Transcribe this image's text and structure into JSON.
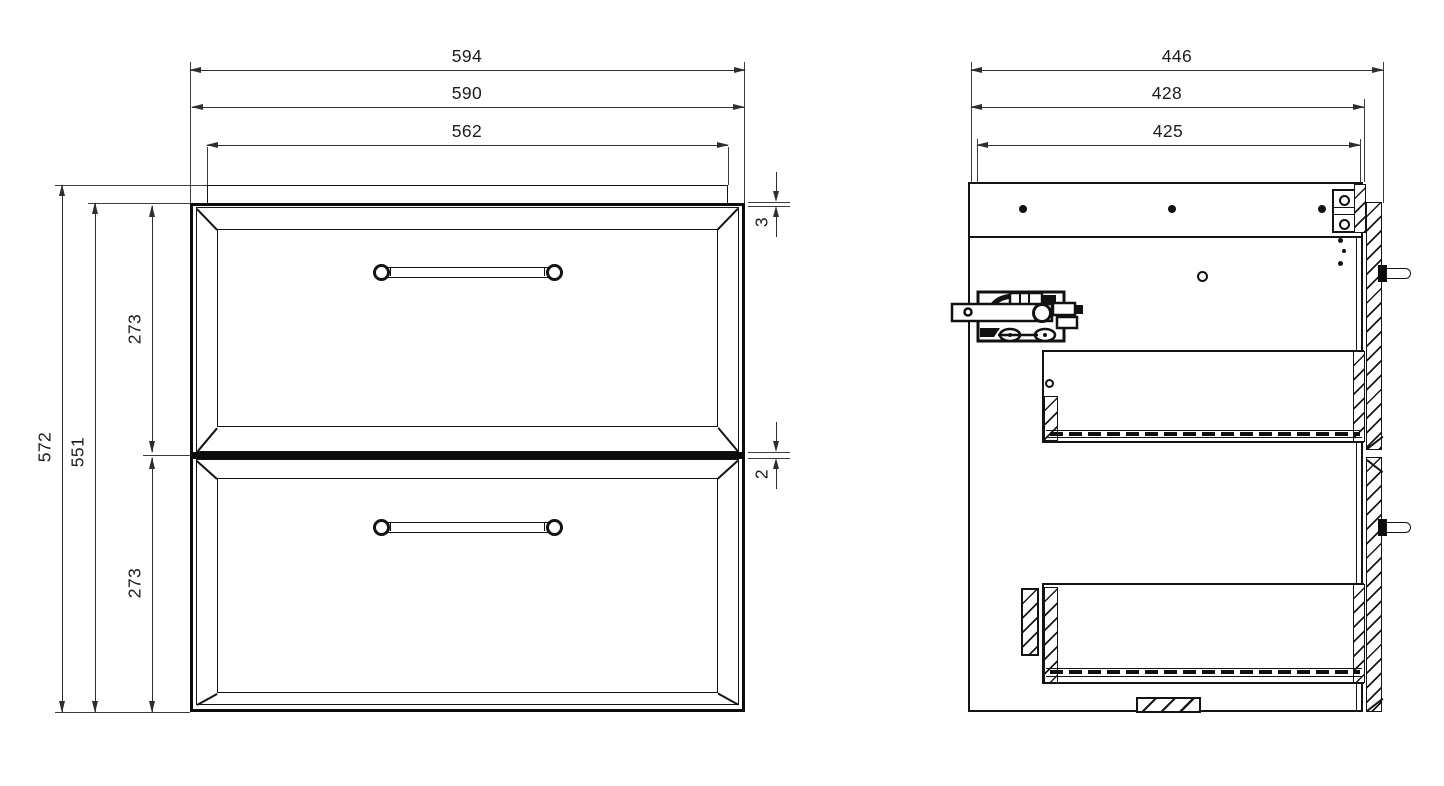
{
  "colors": {
    "background": "#ffffff",
    "line": "#141414",
    "dim_line": "#2e2e2e"
  },
  "front_view": {
    "dims": {
      "overall_width": "594",
      "body_width": "590",
      "top_panel_width": "562",
      "overall_height": "572",
      "body_height": "551",
      "top_drawer_height": "273",
      "bottom_drawer_height": "273",
      "top_reveal": "3",
      "drawer_gap": "2"
    }
  },
  "side_view": {
    "dims": {
      "overall_depth": "446",
      "body_depth": "428",
      "inner_depth": "425"
    }
  }
}
